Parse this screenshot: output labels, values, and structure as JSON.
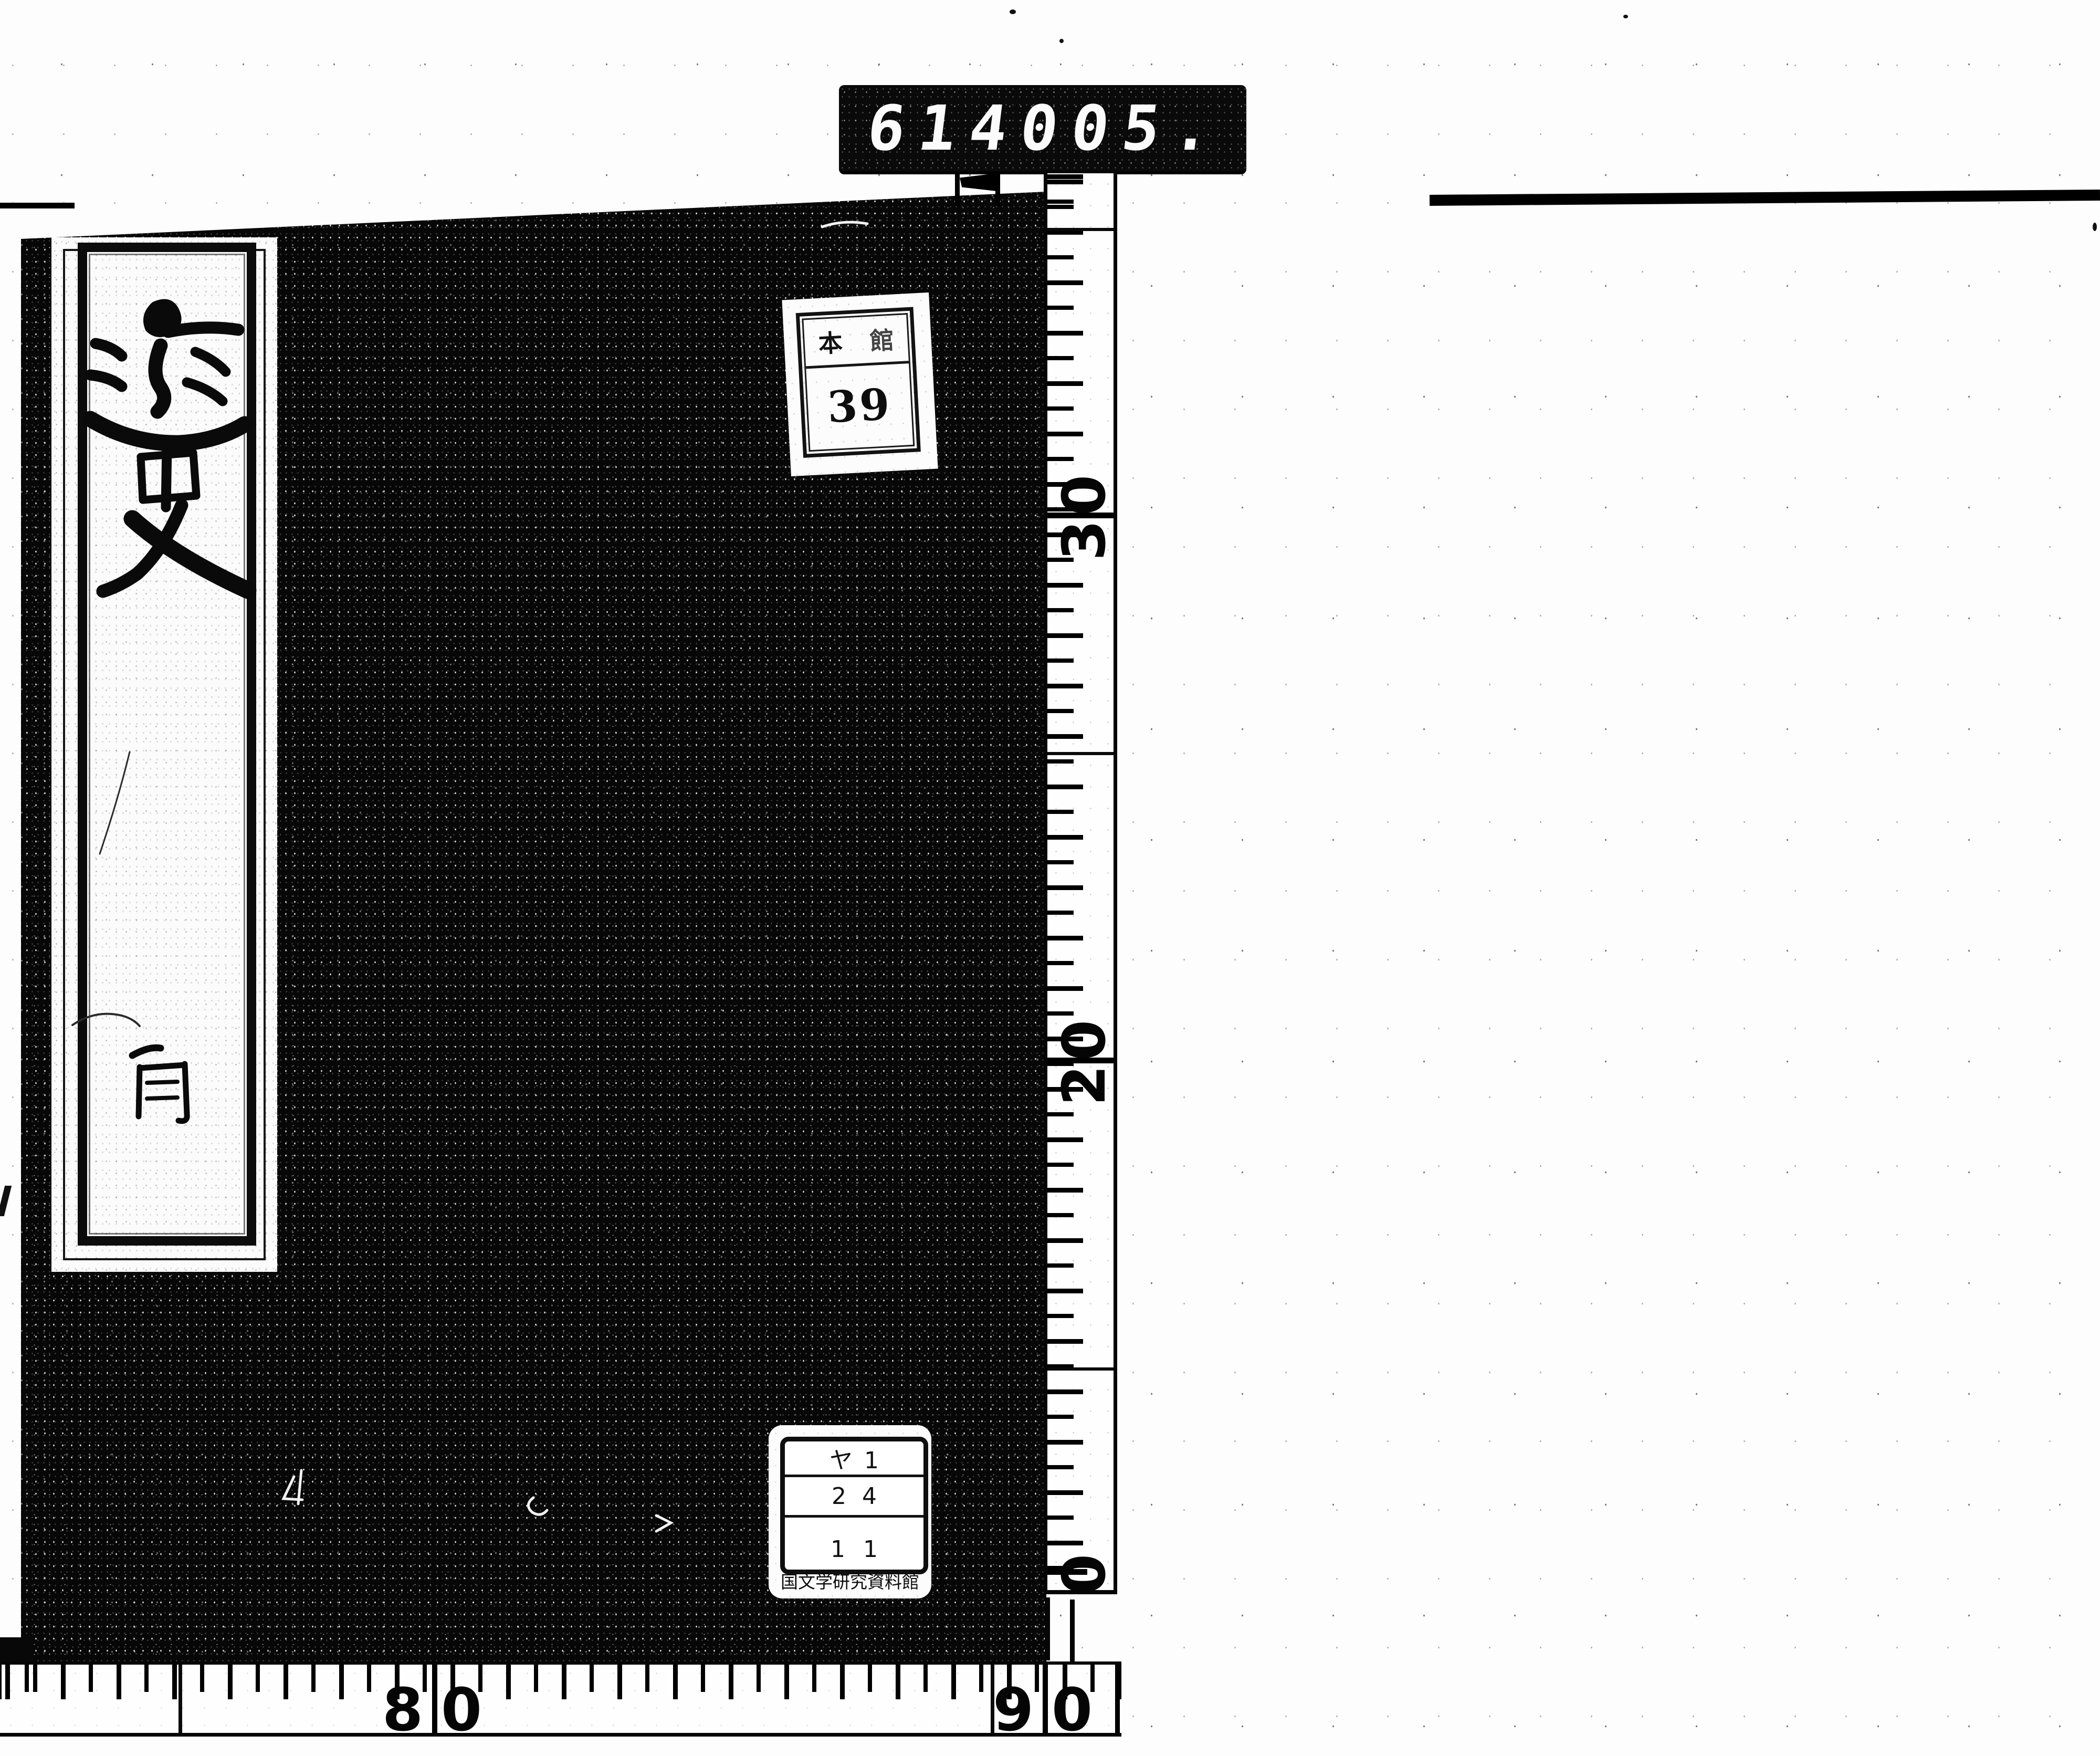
{
  "scanner_counter": {
    "left_digits": "614",
    "right_digits": "005."
  },
  "shelf_label": {
    "header_char_1": "本",
    "header_char_2": "館",
    "number": "39"
  },
  "title_slip": {
    "title": "逸史",
    "volume_char": "首"
  },
  "call_number_label": {
    "rows": [
      "ヤ1",
      "24",
      "11"
    ],
    "institution": "国文学研究資料館"
  },
  "vertical_ruler": {
    "labels": [
      "30",
      "20",
      "0"
    ]
  },
  "horizontal_ruler": {
    "labels": [
      "80",
      "90"
    ]
  },
  "colors": {
    "ink": "#000000",
    "paper": "#ffffff"
  }
}
